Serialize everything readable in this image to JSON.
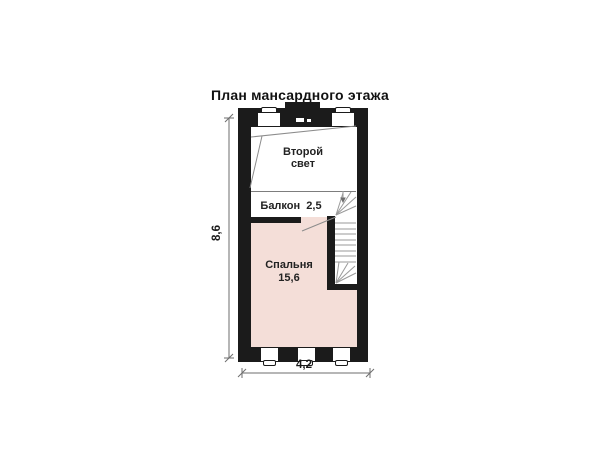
{
  "title": "План мансардного этажа",
  "rooms": {
    "second_light": {
      "name_line1": "Второй",
      "name_line2": "свет"
    },
    "balcony": {
      "name": "Балкон",
      "area": "2,5"
    },
    "bedroom": {
      "name": "Спальня",
      "area": "15,6"
    }
  },
  "dimensions": {
    "vertical": "8,6",
    "horizontal": "4,2"
  },
  "symbols": {
    "windows_top": 2,
    "windows_bottom": 3,
    "chimney_vent": "chimney-vent-symbol",
    "staircase": "winder-staircase"
  },
  "colors": {
    "wall": "#1b1b1b",
    "bedroom_fill": "#f4ded8",
    "plan_line": "#8c8c8c",
    "stair_line": "#9a9a9a",
    "dimension_line": "#6e6e6e",
    "background": "#ffffff",
    "text": "#1a1a1a"
  }
}
